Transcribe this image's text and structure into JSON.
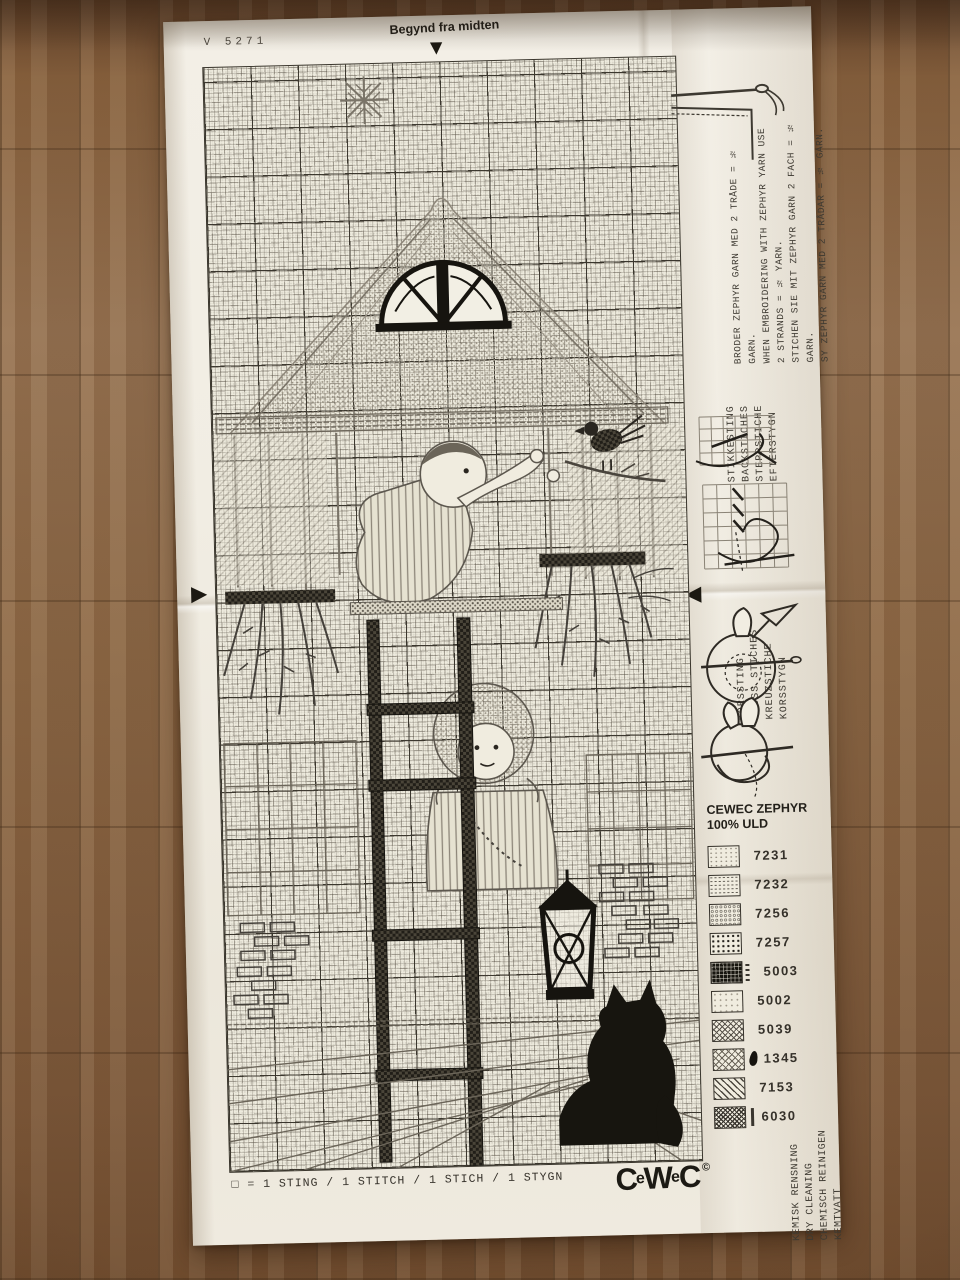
{
  "colors": {
    "wood_floor": "#8a6746",
    "paper": "#f1ede3",
    "ink": "#35312a",
    "grid_line": "#3a362d"
  },
  "header": {
    "pattern_number": "V 5271",
    "start_label": "Begynd fra midten"
  },
  "side_panel": {
    "yarn_instructions": "BRODER ZEPHYR GARN MED 2 TRÅDE = ½ GARN.\nWHEN EMBROIDERING WITH ZEPHYR YARN USE\n2 STRANDS = ½ YARN.\nSTICHEN SIE MIT ZEPHYR GARN 2 FACH = ½ GARN.\nSY ZEPHYR GARN MED 2 TRÅDAR = ½ GARN.",
    "backstitch_heading": "STIKKESTING\nBACKSTICHES\nSTEPPSTICHE\nEFTERSTYGN",
    "cross_stitch_heading": "KORSSTING\nCROSS STICHES\nKREUZSTICHE\nKORSSTYGN",
    "care_note": "KEMISK RENSNING\nDRY CLEANING\nCHEMISCH REINIGEN\nKEMTVATT"
  },
  "legend": {
    "title": "CEWEC ZEPHYR\n100% ULD",
    "entries": [
      {
        "code": "7231",
        "symbol": "sparse light dashes"
      },
      {
        "code": "7232",
        "symbol": "light horizontal dashes"
      },
      {
        "code": "7256",
        "symbol": "small open circles"
      },
      {
        "code": "7257",
        "symbol": "bold dot grid"
      },
      {
        "code": "5003",
        "symbol": "solid black squares"
      },
      {
        "code": "5002",
        "symbol": "faint dots"
      },
      {
        "code": "5039",
        "symbol": "diamond crosshatch"
      },
      {
        "code": "1345",
        "symbol": "diamond crosshatch with leaf mark"
      },
      {
        "code": "7153",
        "symbol": "diagonal dashes"
      },
      {
        "code": "6030",
        "symbol": "dense crosshatch"
      }
    ]
  },
  "footer": {
    "stitch_key": "□ = 1 STING / 1 STITCH / 1 STICH / 1 STYGN",
    "brand_letters": [
      "C",
      "e",
      "W",
      "e",
      "C"
    ],
    "copyright": "©"
  }
}
